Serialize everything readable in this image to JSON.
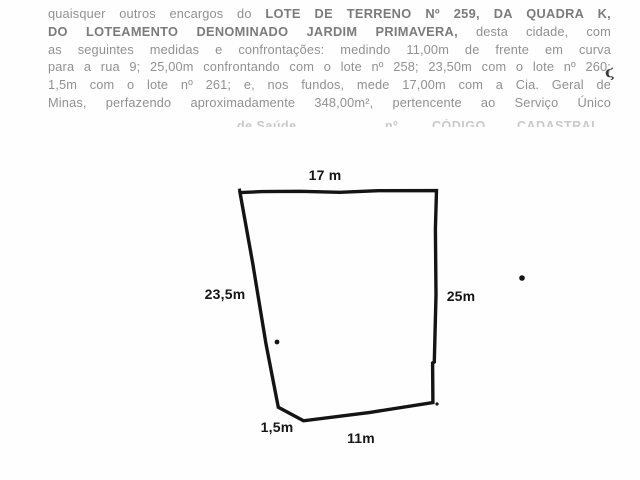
{
  "document": {
    "lines": [
      {
        "segments": [
          {
            "text": "quaisquer outros encargos do ",
            "bold": false
          },
          {
            "text": "LOTE DE TERRENO Nº 259, DA QUADRA K,",
            "bold": true
          }
        ]
      },
      {
        "segments": [
          {
            "text": "DO LOTEAMENTO DENOMINADO JARDIM PRIMAVERA,",
            "bold": true
          },
          {
            "text": " desta cidade, com",
            "bold": false
          }
        ]
      },
      {
        "segments": [
          {
            "text": "as seguintes medidas e confrontações: medindo 11,00m de frente em curva",
            "bold": false
          }
        ]
      },
      {
        "segments": [
          {
            "text": "para a rua 9; 25,00m confrontando com o lote nº 258; 23,50m com o lote nº 260;",
            "bold": false
          }
        ]
      },
      {
        "segments": [
          {
            "text": "1,5m com o lote nº 261; e, nos fundos, mede 17,00m com a Cia. Geral de",
            "bold": false
          }
        ]
      },
      {
        "segments": [
          {
            "text": "Minas, perfazendo aproximadamente 348,00m², pertencente ao Serviço Único",
            "bold": false
          }
        ]
      }
    ],
    "clipped_line_fragments": [
      "de Saúde",
      "nº",
      "CÓDIGO",
      "CADASTRAL"
    ],
    "pen_mark": "ϛ"
  },
  "diagram": {
    "labels": {
      "top": "17 m",
      "left": "23,5m",
      "right": "25m",
      "bottom_left": "1,5m",
      "bottom": "11m"
    }
  },
  "colors": {
    "ink": "#141414",
    "text_gray": "#919191",
    "bold_gray": "#7b7b7b",
    "faded_gray": "#c9c9c9",
    "background": "#fefefe"
  }
}
